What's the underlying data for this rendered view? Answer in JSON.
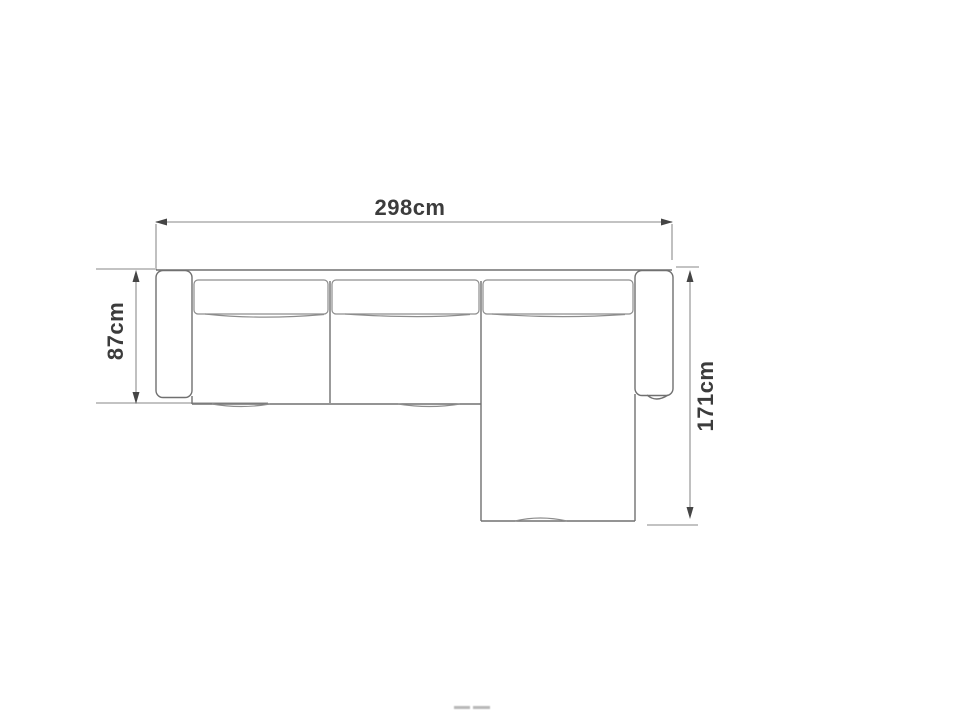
{
  "diagram": {
    "kind": "sectional-sofa-top-view-dimension-drawing",
    "labels": {
      "width": "298cm",
      "depth": "87cm",
      "chaise": "171cm"
    },
    "colors": {
      "background": "#ffffff",
      "sofa_outline": "#707070",
      "cushion_line": "#8d8d8d",
      "dimension_line": "#9f9f9f",
      "arrowhead": "#454545",
      "label_text": "#3c3c3c"
    }
  }
}
